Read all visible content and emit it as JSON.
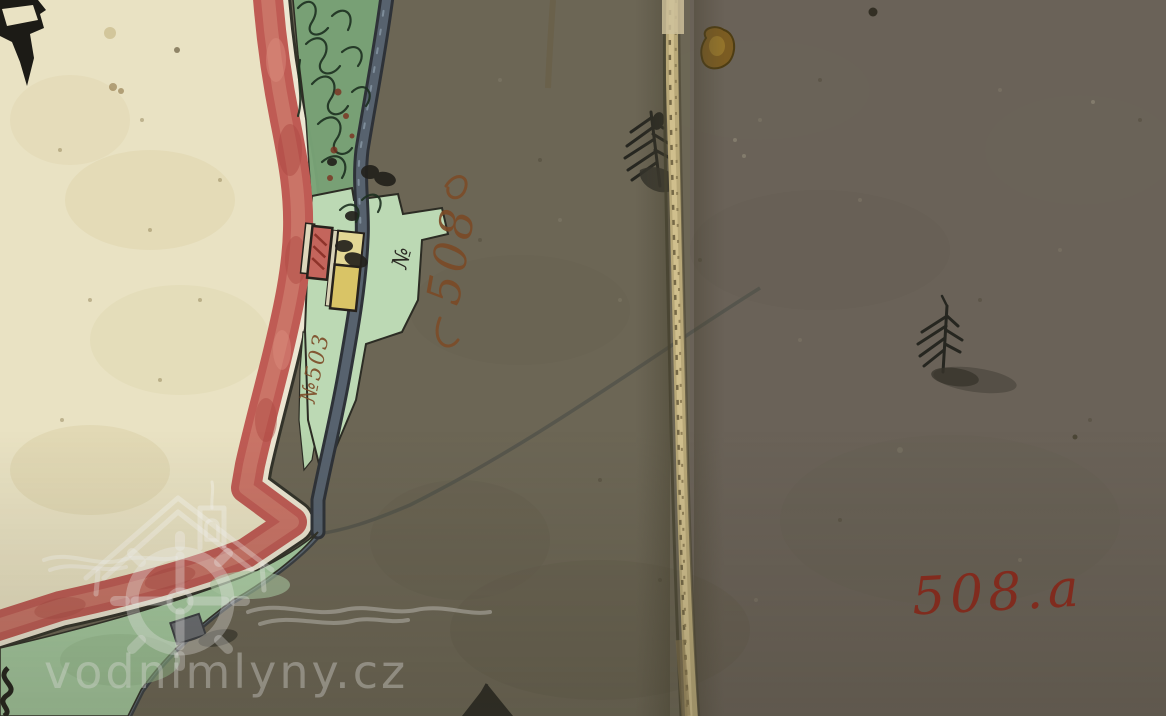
{
  "artifact": {
    "kind": "scanned hand-drawn historical cadastral map sheet",
    "fold": "vertical stitched sheet seam"
  },
  "labels": {
    "red_parcel_number": "508.a",
    "mill_parcel_number": "508",
    "strip_parcel_number": "№503",
    "numero_mark": "№"
  },
  "watermark": {
    "text": "vodnimlyny.cz",
    "logo": "mill-house-with-water-wheel-and-waves"
  },
  "features": {
    "trees": "ink fir-tree symbols",
    "buildings": [
      "red masonry mill building",
      "yellow wooden building"
    ],
    "water": "blue-grey mill race and stream lines"
  },
  "colors": {
    "field_dark": "#6c6655",
    "field_dark_right": "#6a6258",
    "parchment": "#e9e2c3",
    "border_red": "#bf5b54",
    "strip_green": "#79a377",
    "parcel_mint": "#bcd9b4",
    "water_channel": "#57626e",
    "ink": "#2b2a23",
    "brown_ink": "#7c4a26",
    "red_ink": "#8b2a1d",
    "seam_thread": "#bfae7f"
  }
}
